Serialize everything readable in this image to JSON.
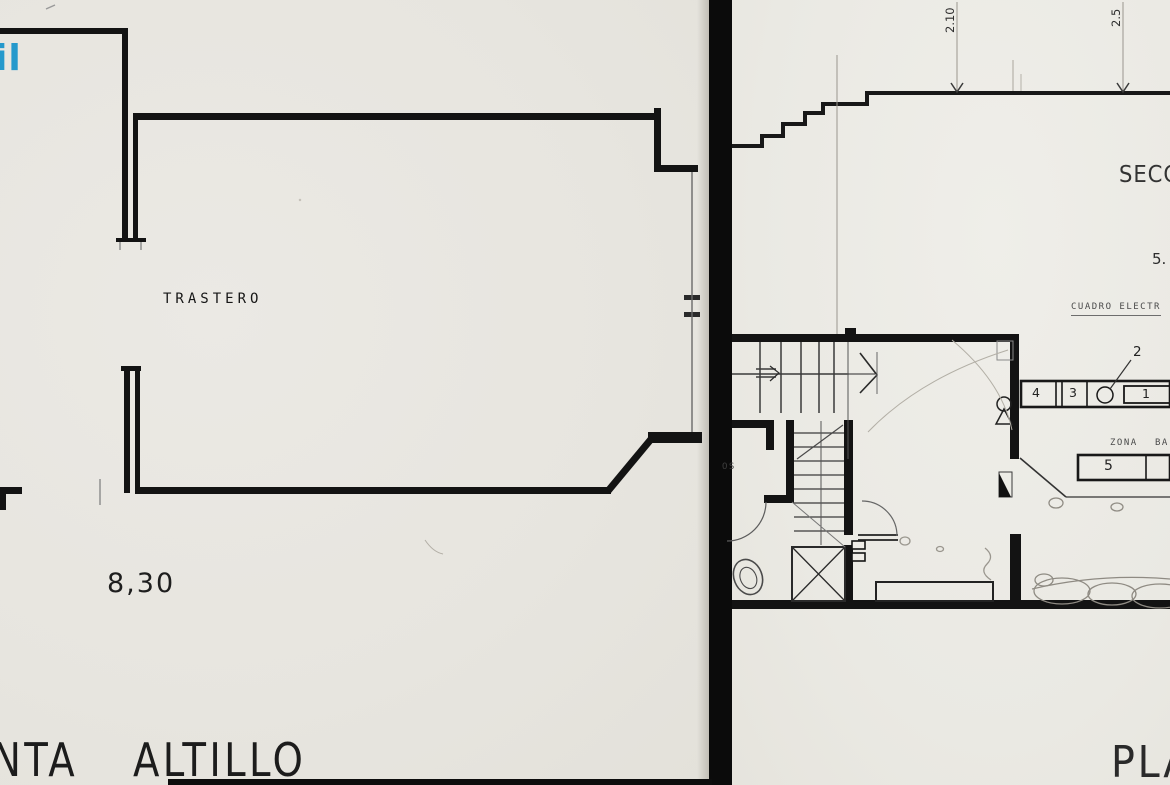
{
  "document": {
    "kind": "scanned architectural floor plan, two sheets split by black scan divider",
    "canvas": {
      "width": 1170,
      "height": 785
    }
  },
  "colors": {
    "paper": "#e9e7e1",
    "ink": "#141414",
    "thin_line": "#333333",
    "pencil": "#8f8b83",
    "watermark_blue": "#2599cc",
    "divider_black": "#0b0b0b"
  },
  "watermark": {
    "text_fragment": "il"
  },
  "left_plan": {
    "room_label": "TRASTERO",
    "width_dimension": "8,30",
    "title_fragment_1": "NTA",
    "title_fragment_2": "ALTILLO"
  },
  "right_plan": {
    "dim_vertical_1": "2.10",
    "dim_vertical_2": "2.5",
    "section_title_fragment": "SECC",
    "dim_right_fragment": "5.",
    "electrical_panel_label": "CUADRO ELECTR",
    "callout_label": "2",
    "shelf_cells": [
      "4",
      "3",
      "1"
    ],
    "zona_label": "ZONA",
    "barra_label_fragment": "BA",
    "counter_cell_label": "5",
    "aseos_label_fragment": "OS",
    "plan_title_fragment": "PLA"
  },
  "symbols": {
    "person-icon": "circle-over-triangle plan symbol",
    "toilet-icon": "double-oval toilet plan symbol",
    "electrical-circle-icon": "empty circle cell with leader to callout 2",
    "stair-direction-arrow-icon": "chevron arrow pointing right",
    "door-swing-icon": "quarter-circle arc"
  }
}
